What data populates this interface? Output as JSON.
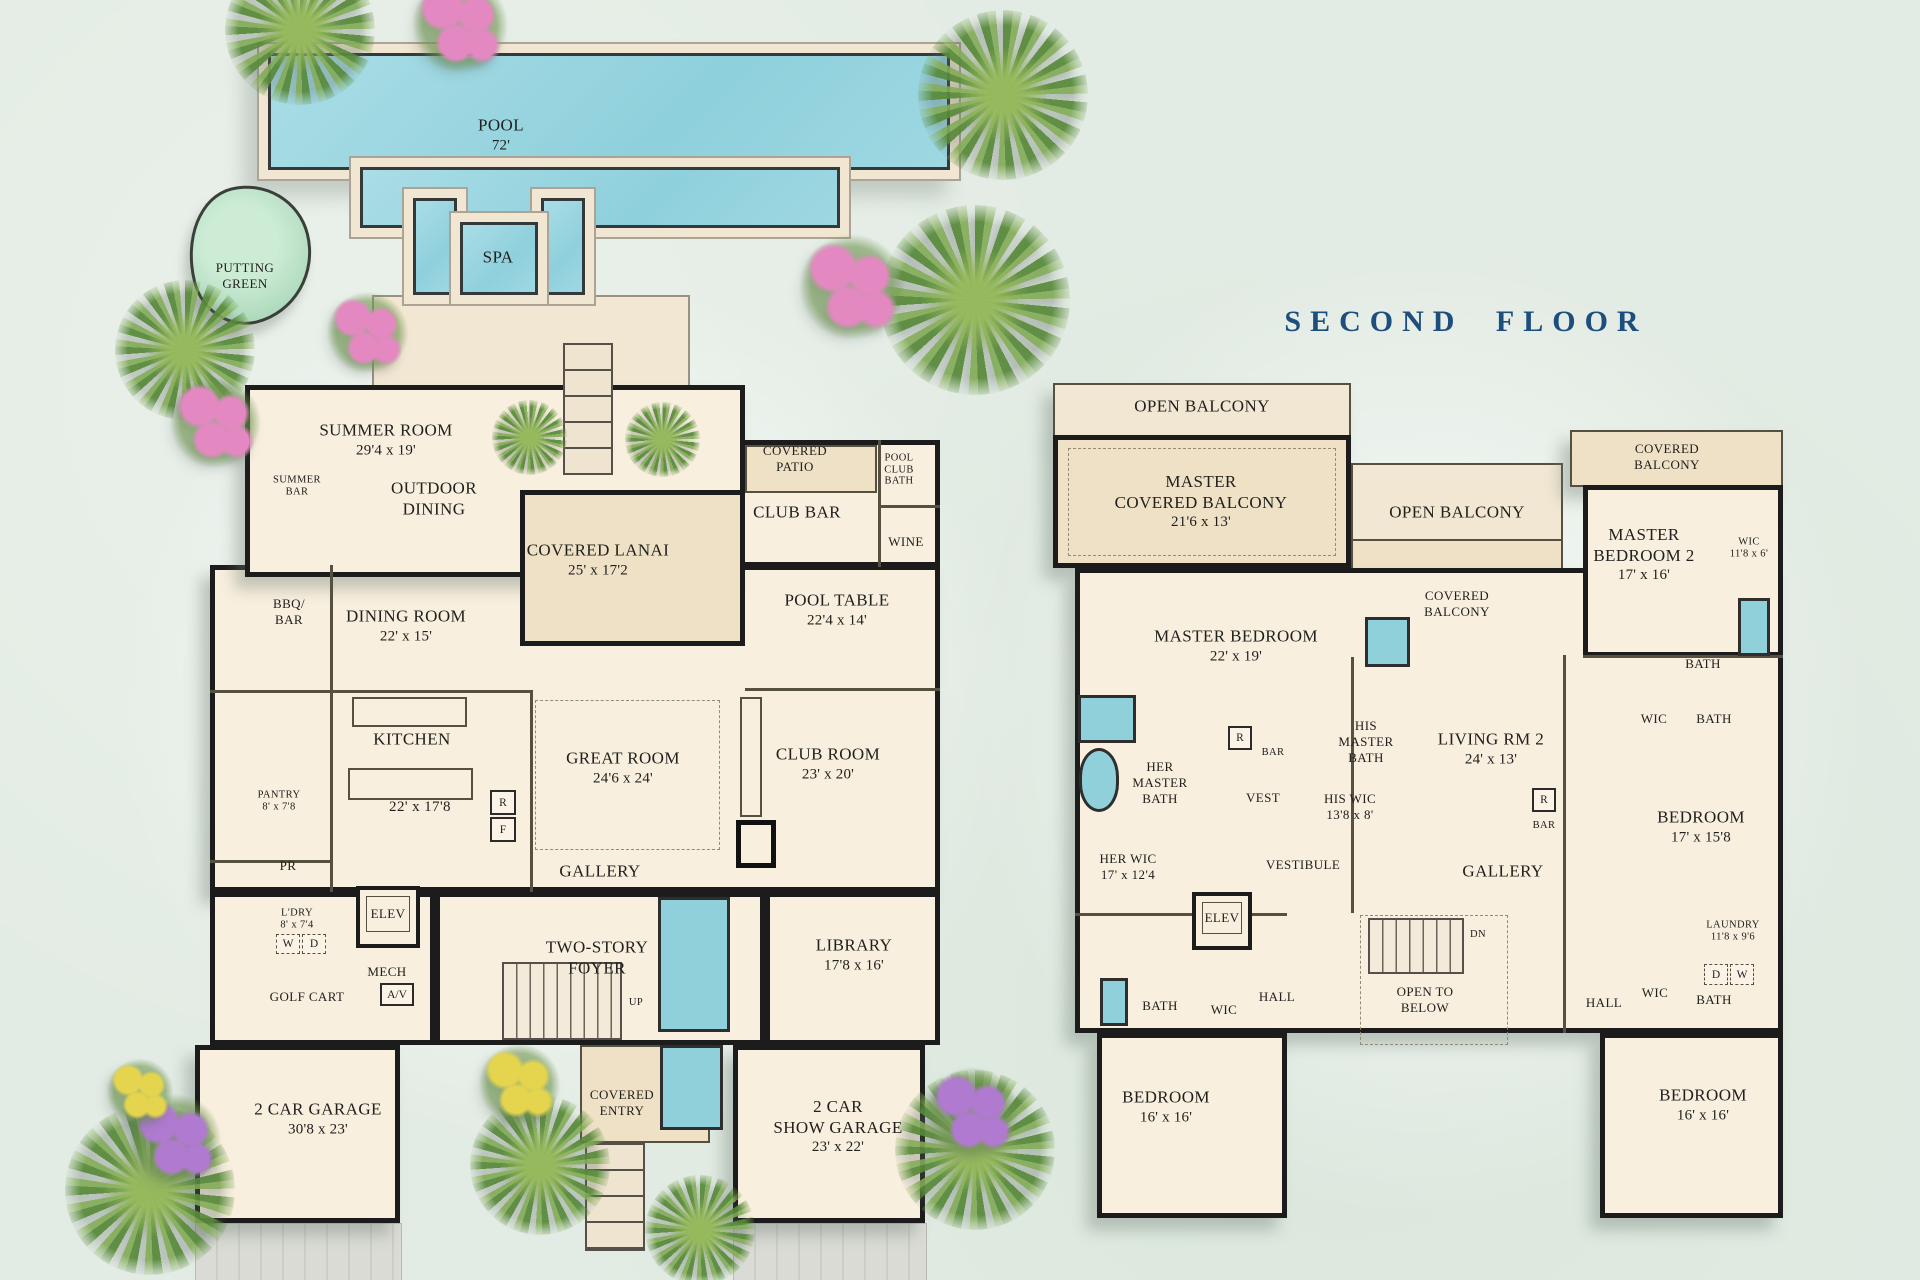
{
  "title": "SECOND FLOOR",
  "colors": {
    "background": "#e3ece4",
    "walls": "#1c1c1c",
    "floor_cream": "#f8efde",
    "covered_tan": "#efe1c6",
    "water_teal": "#9ed8e2",
    "title_navy": "#1d4e7e",
    "putting_green": "#abd8ba"
  },
  "ff": {
    "pool": {
      "label": "POOL",
      "dim": "72'"
    },
    "spa": {
      "label": "SPA"
    },
    "putting_green": {
      "label": "PUTTING\nGREEN"
    },
    "summer_room": {
      "label": "SUMMER ROOM",
      "dim": "29'4 x 19'"
    },
    "summer_bar": {
      "label": "SUMMER\nBAR"
    },
    "outdoor_dining": {
      "label": "OUTDOOR\nDINING"
    },
    "covered_lanai": {
      "label": "COVERED LANAI",
      "dim": "25' x 17'2"
    },
    "covered_patio": {
      "label": "COVERED\nPATIO"
    },
    "pool_club_bath": {
      "label": "POOL\nCLUB\nBATH"
    },
    "club_bar": {
      "label": "CLUB BAR"
    },
    "wine": {
      "label": "WINE"
    },
    "bbq_bar": {
      "label": "BBQ/\nBAR"
    },
    "dining_room": {
      "label": "DINING ROOM",
      "dim": "22' x 15'"
    },
    "pool_table": {
      "label": "POOL TABLE",
      "dim": "22'4 x 14'"
    },
    "kitchen": {
      "label": "KITCHEN",
      "dim": "22' x 17'8"
    },
    "fridge": "R",
    "freezer": "F",
    "pantry": {
      "label": "PANTRY",
      "dim": "8' x 7'8"
    },
    "powder": {
      "label": "PR"
    },
    "great_room": {
      "label": "GREAT ROOM",
      "dim": "24'6 x 24'"
    },
    "club_room": {
      "label": "CLUB ROOM",
      "dim": "23' x 20'"
    },
    "gallery": {
      "label": "GALLERY"
    },
    "laundry": {
      "label": "L'DRY",
      "dim": "8' x 7'4"
    },
    "washer": "W",
    "dryer": "D",
    "elevator": {
      "label": "ELEV"
    },
    "mech": {
      "label": "MECH"
    },
    "av": "A/V",
    "golf_cart": {
      "label": "GOLF CART"
    },
    "foyer": {
      "label": "TWO-STORY\nFOYER"
    },
    "up": "UP",
    "library": {
      "label": "LIBRARY",
      "dim": "17'8 x 16'"
    },
    "garage": {
      "label": "2 CAR GARAGE",
      "dim": "30'8 x 23'"
    },
    "covered_entry": {
      "label": "COVERED\nENTRY"
    },
    "show_garage": {
      "label": "2 CAR\nSHOW GARAGE",
      "dim": "23' x 22'"
    }
  },
  "sf": {
    "open_balcony_top": {
      "label": "OPEN BALCONY"
    },
    "master_covered_balcony": {
      "label": "MASTER\nCOVERED BALCONY",
      "dim": "21'6 x 13'"
    },
    "open_balcony_mid": {
      "label": "OPEN BALCONY"
    },
    "covered_balcony_mid": {
      "label": "COVERED\nBALCONY"
    },
    "covered_balcony_right": {
      "label": "COVERED\nBALCONY"
    },
    "master_bedroom": {
      "label": "MASTER BEDROOM",
      "dim": "22' x 19'"
    },
    "master_bedroom_2": {
      "label": "MASTER\nBEDROOM 2",
      "dim": "17' x 16'"
    },
    "wic_mb2": {
      "label": "WIC",
      "dim": "11'8 x 6'"
    },
    "her_master_bath": {
      "label": "HER\nMASTER\nBATH"
    },
    "his_master_bath": {
      "label": "HIS\nMASTER\nBATH"
    },
    "vest": {
      "label": "VEST"
    },
    "bar_left": "BAR",
    "r_left": "R",
    "his_wic": {
      "label": "HIS WIC",
      "dim": "13'8 x 8'"
    },
    "living_rm_2": {
      "label": "LIVING RM 2",
      "dim": "24' x 13'"
    },
    "bar_right": "BAR",
    "r_right": "R",
    "bath_top_right": {
      "label": "BATH"
    },
    "wic_r1": {
      "label": "WIC"
    },
    "bath_r1": {
      "label": "BATH"
    },
    "bedroom_right": {
      "label": "BEDROOM",
      "dim": "17' x 15'8"
    },
    "her_wic": {
      "label": "HER WIC",
      "dim": "17' x 12'4"
    },
    "elevator": {
      "label": "ELEV"
    },
    "vestibule": {
      "label": "VESTIBULE"
    },
    "gallery": {
      "label": "GALLERY"
    },
    "open_to_below": {
      "label": "OPEN TO\nBELOW"
    },
    "dn": "DN",
    "bath_left": {
      "label": "BATH"
    },
    "wic_left": {
      "label": "WIC"
    },
    "hall_left": {
      "label": "HALL"
    },
    "laundry": {
      "label": "LAUNDRY",
      "dim": "11'8 x 9'6"
    },
    "dryer": "D",
    "washer": "W",
    "hall_right": {
      "label": "HALL"
    },
    "wic_r2": {
      "label": "WIC"
    },
    "bath_r2": {
      "label": "BATH"
    },
    "bedroom_bl": {
      "label": "BEDROOM",
      "dim": "16' x 16'"
    },
    "bedroom_br": {
      "label": "BEDROOM",
      "dim": "16' x 16'"
    }
  }
}
